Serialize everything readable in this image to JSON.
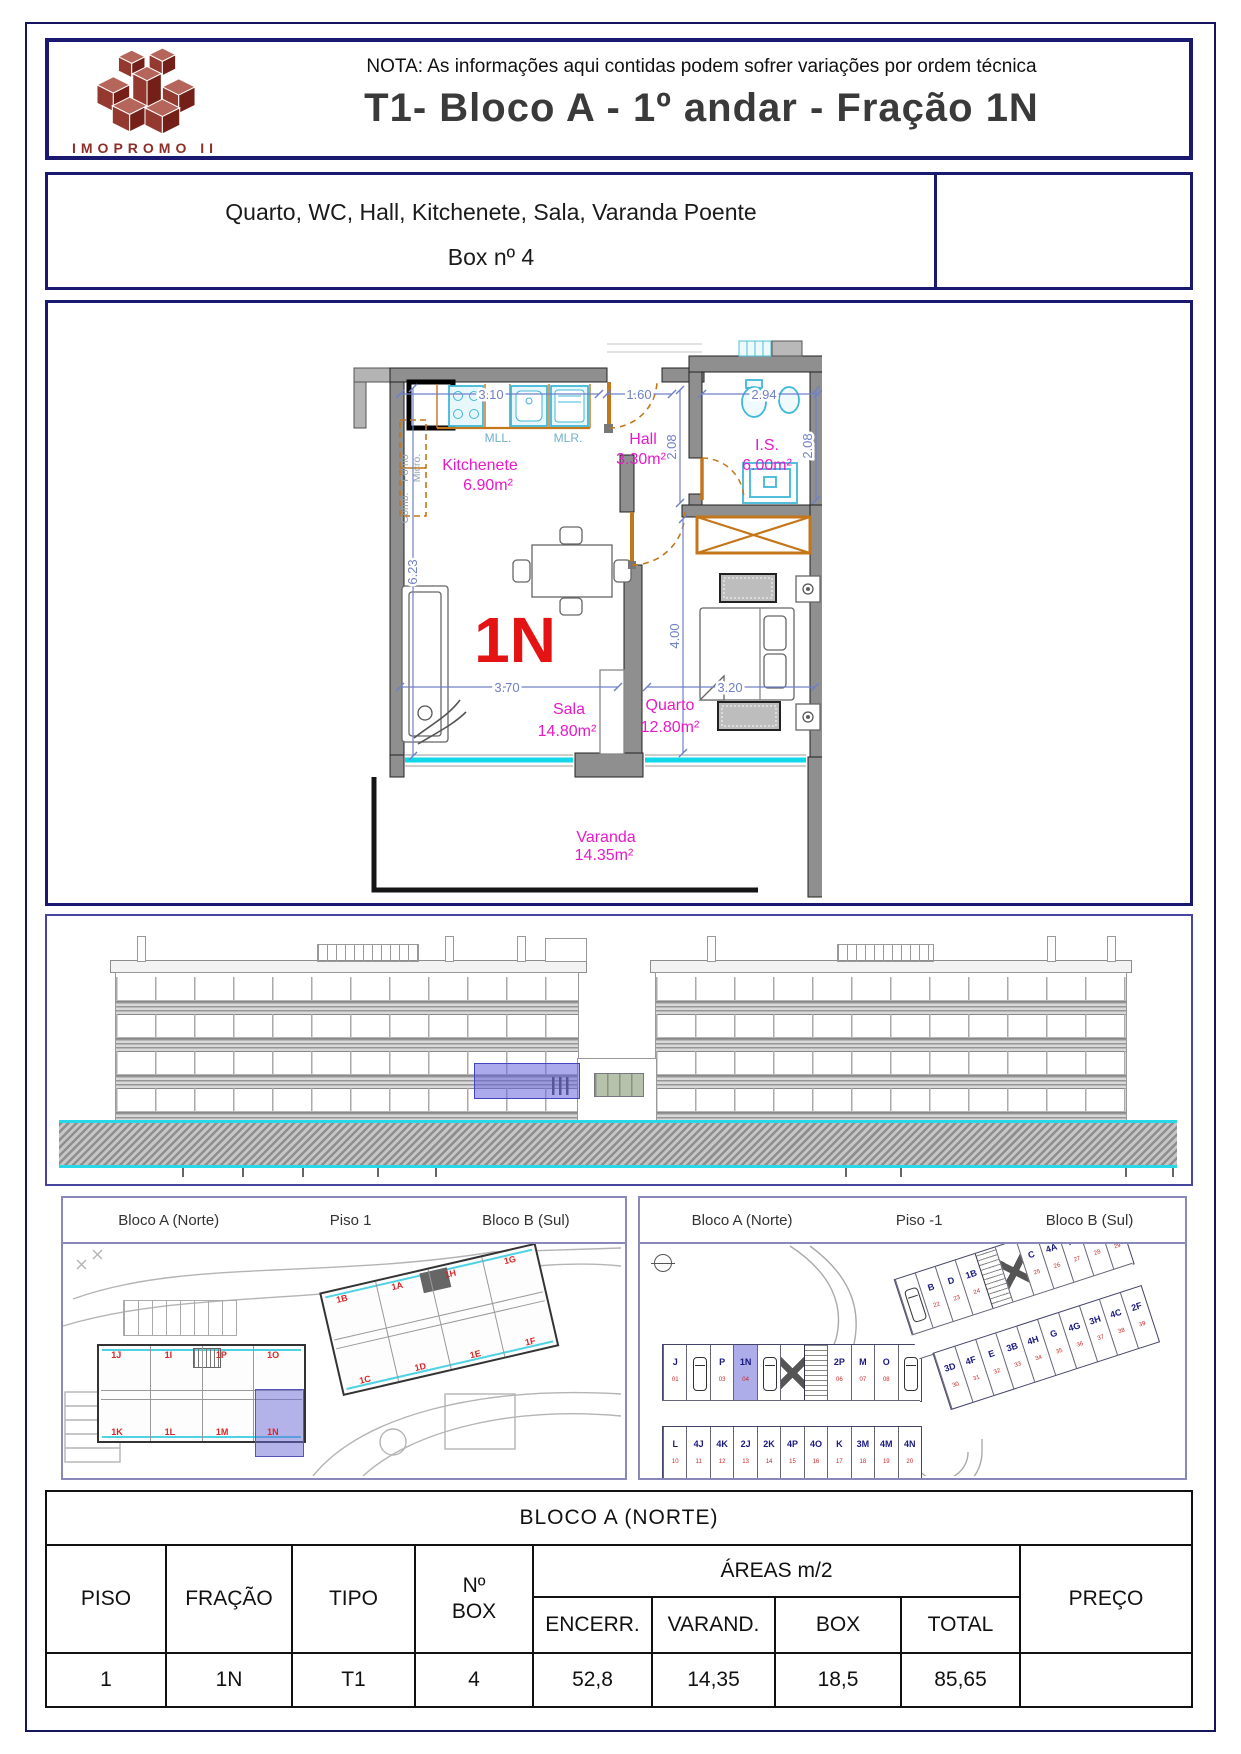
{
  "header": {
    "note": "NOTA: As informações aqui contidas podem sofrer variações por ordem técnica",
    "title": "T1- Bloco A - 1º andar - Fração 1N",
    "logo_text": "IMOPROMO II"
  },
  "summary": {
    "line1": "Quarto, WC, Hall, Kitchenete, Sala, Varanda Poente",
    "line2": "Box nº 4"
  },
  "floorplan": {
    "unit": "1N",
    "rooms": {
      "kitchenete": {
        "name": "Kitchenete",
        "area": "6.90m²"
      },
      "hall": {
        "name": "Hall",
        "area": "3.30m²"
      },
      "is": {
        "name": "I.S.",
        "area": "6.00m²"
      },
      "sala": {
        "name": "Sala",
        "area": "14.80m²"
      },
      "quarto": {
        "name": "Quarto",
        "area": "12.80m²"
      },
      "varanda": {
        "name": "Varanda",
        "area": "14.35m²"
      }
    },
    "appliances": {
      "mll": "MLL.",
      "mlr": "MLR.",
      "comb": "Comb.",
      "forno": "Forno",
      "micro": "Micro."
    },
    "dims": {
      "kitchen_w": "3.10",
      "hall_w": "1.60",
      "is_w": "2.94",
      "hall_h": "2.08",
      "is_h": "2.08",
      "left_h": "6.23",
      "sala_w": "3.70",
      "quarto_w": "3.20",
      "quarto_h": "4.00"
    }
  },
  "piso1": {
    "bloco_a_label": "Bloco A (Norte)",
    "piso_label": "Piso 1",
    "bloco_b_label": "Bloco B (Sul)",
    "a_top": [
      {
        "t": "1J"
      },
      {
        "t": "1I"
      },
      {
        "t": "1P"
      },
      {
        "t": "1O"
      }
    ],
    "a_bottom": [
      {
        "t": "1K"
      },
      {
        "t": "1L"
      },
      {
        "t": "1M"
      },
      {
        "t": "1N",
        "hl": true
      }
    ],
    "b_top": [
      {
        "t": "1B"
      },
      {
        "t": "1A"
      },
      {
        "t": "1H"
      },
      {
        "t": "1G"
      }
    ],
    "b_bottom": [
      {
        "t": "1C"
      },
      {
        "t": "1D"
      },
      {
        "t": "1E"
      },
      {
        "t": "1F"
      }
    ]
  },
  "pisom1": {
    "bloco_a_label": "Bloco A (Norte)",
    "piso_label": "Piso -1",
    "bloco_b_label": "Bloco B (Sul)",
    "a_top": [
      {
        "l": "J",
        "n": "01"
      },
      {
        "n": "02",
        "car": true
      },
      {
        "l": "P",
        "n": "03"
      },
      {
        "l": "1N",
        "n": "04",
        "hl": true
      },
      {
        "l": "4I",
        "n": "05",
        "car": true
      },
      {
        "elev": true
      },
      {
        "stairs": true
      },
      {
        "l": "2P",
        "n": "06"
      },
      {
        "l": "M",
        "n": "07"
      },
      {
        "l": "O",
        "n": "08"
      },
      {
        "l": "4L",
        "n": "09",
        "car": true
      }
    ],
    "a_bottom": [
      {
        "l": "L",
        "n": "10"
      },
      {
        "l": "4J",
        "n": "11"
      },
      {
        "l": "4K",
        "n": "12"
      },
      {
        "l": "2J",
        "n": "13"
      },
      {
        "l": "2K",
        "n": "14"
      },
      {
        "l": "4P",
        "n": "15"
      },
      {
        "l": "4O",
        "n": "16"
      },
      {
        "l": "K",
        "n": "17"
      },
      {
        "l": "3M",
        "n": "18"
      },
      {
        "l": "4M",
        "n": "19"
      },
      {
        "l": "4N",
        "n": "20"
      }
    ],
    "b_top": [
      {
        "l": "2B",
        "n": "21",
        "car": true
      },
      {
        "l": "B",
        "n": "22"
      },
      {
        "l": "D",
        "n": "23"
      },
      {
        "l": "1B",
        "n": "24"
      },
      {
        "stairs": true
      },
      {
        "elev": true
      },
      {
        "l": "C",
        "n": "25"
      },
      {
        "l": "4A",
        "n": "26"
      },
      {
        "l": "A",
        "n": "27"
      },
      {
        "l": "H",
        "n": "28"
      },
      {
        "l": "4B",
        "n": "29"
      }
    ],
    "b_bottom": [
      {
        "l": "3D",
        "n": "30"
      },
      {
        "l": "4F",
        "n": "31"
      },
      {
        "l": "E",
        "n": "32"
      },
      {
        "l": "3B",
        "n": "33"
      },
      {
        "l": "4H",
        "n": "34"
      },
      {
        "l": "G",
        "n": "35"
      },
      {
        "l": "4G",
        "n": "36"
      },
      {
        "l": "3H",
        "n": "37"
      },
      {
        "l": "4C",
        "n": "38"
      },
      {
        "l": "2F",
        "n": "39"
      }
    ]
  },
  "table": {
    "title": "BLOCO A (NORTE)",
    "headers": {
      "piso": "PISO",
      "fracao": "FRAÇÃO",
      "tipo": "TIPO",
      "nbox1": "Nº",
      "nbox2": "BOX",
      "areas": "ÁREAS m/2",
      "encerr": "ENCERR.",
      "varand": "VARAND.",
      "box": "BOX",
      "total": "TOTAL",
      "preco": "PREÇO"
    },
    "row": {
      "piso": "1",
      "fracao": "1N",
      "tipo": "T1",
      "nbox": "4",
      "encerr": "52,8",
      "varand": "14,35",
      "box": "18,5",
      "total": "85,65",
      "preco": ""
    }
  },
  "colors": {
    "navy": "#191970",
    "magenta": "#e81ac8",
    "red": "#e41414",
    "dim_blue": "#7080c8",
    "orange": "#c4761a",
    "cyan": "#2ec8e0",
    "wall_gray": "#8f8f8f",
    "highlight": "#6a6ad8",
    "logo_red": "#8c3a32"
  }
}
